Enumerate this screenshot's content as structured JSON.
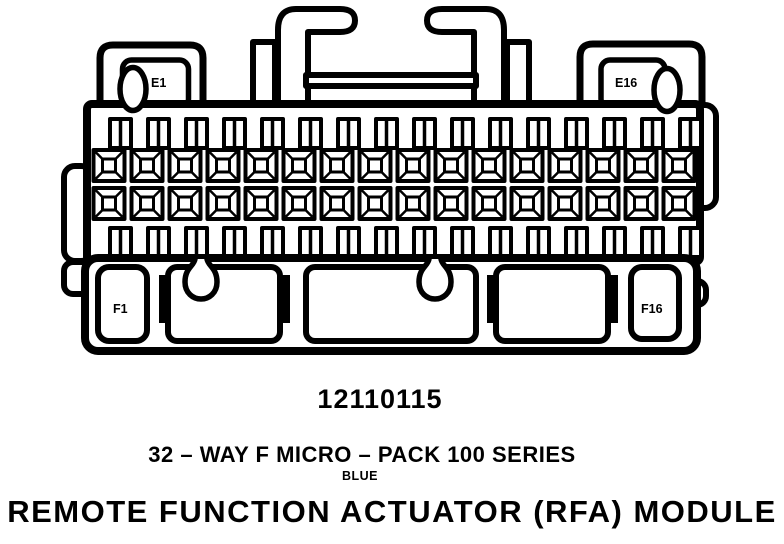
{
  "diagram": {
    "type": "connector-face-view",
    "ink_color": "#000000",
    "background_color": "#ffffff",
    "connector": {
      "cavity_labels": {
        "top_left": "E1",
        "top_right": "E16",
        "bottom_left": "F1",
        "bottom_right": "F16"
      },
      "grid": {
        "columns": 16,
        "square_terminal_rows": 2,
        "slot_rows": 2,
        "total_ways": 32
      }
    },
    "captions": {
      "part_number": "12110115",
      "series": "32 – WAY F MICRO – PACK 100 SERIES",
      "color": "BLUE",
      "module": "REMOTE FUNCTION ACTUATOR (RFA) MODULE"
    }
  }
}
